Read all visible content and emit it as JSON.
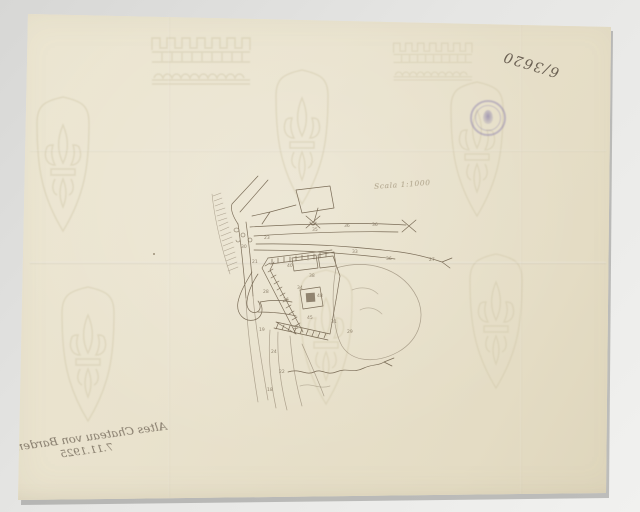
{
  "scan": {
    "colors": {
      "background_color": "#e2e2e0",
      "paper_color": "#e9e2cd",
      "ink_color": "#7a6c57",
      "pencil_color": "#a09379",
      "watermark_color": "#d2c9ab",
      "stamp_color": "#8278ab",
      "handwriting_color": "#5b5044"
    }
  },
  "annotations": {
    "archive_number": "6/3620",
    "scale_note": "Scala 1:1000",
    "verso_line1": "Altes Chateau von Barden",
    "verso_line2": "7.11.1925"
  },
  "map": {
    "spot_heights": [
      {
        "v": "36",
        "x": 344,
        "y": 227
      },
      {
        "v": "36",
        "x": 372,
        "y": 226
      },
      {
        "v": "35",
        "x": 312,
        "y": 231
      },
      {
        "v": "33",
        "x": 352,
        "y": 253
      },
      {
        "v": "23",
        "x": 264,
        "y": 239
      },
      {
        "v": "30",
        "x": 241,
        "y": 248
      },
      {
        "v": "21",
        "x": 252,
        "y": 263
      },
      {
        "v": "40",
        "x": 287,
        "y": 267
      },
      {
        "v": "38",
        "x": 309,
        "y": 277
      },
      {
        "v": "34",
        "x": 297,
        "y": 289
      },
      {
        "v": "28",
        "x": 263,
        "y": 293
      },
      {
        "v": "48",
        "x": 317,
        "y": 297
      },
      {
        "v": "26",
        "x": 283,
        "y": 301
      },
      {
        "v": "45",
        "x": 307,
        "y": 319
      },
      {
        "v": "31",
        "x": 331,
        "y": 323
      },
      {
        "v": "52",
        "x": 293,
        "y": 329
      },
      {
        "v": "29",
        "x": 347,
        "y": 333
      },
      {
        "v": "36",
        "x": 386,
        "y": 260
      },
      {
        "v": "19",
        "x": 259,
        "y": 331
      },
      {
        "v": "24",
        "x": 271,
        "y": 353
      },
      {
        "v": "22",
        "x": 279,
        "y": 373
      },
      {
        "v": "27",
        "x": 429,
        "y": 261
      },
      {
        "v": "18",
        "x": 267,
        "y": 391
      }
    ]
  }
}
